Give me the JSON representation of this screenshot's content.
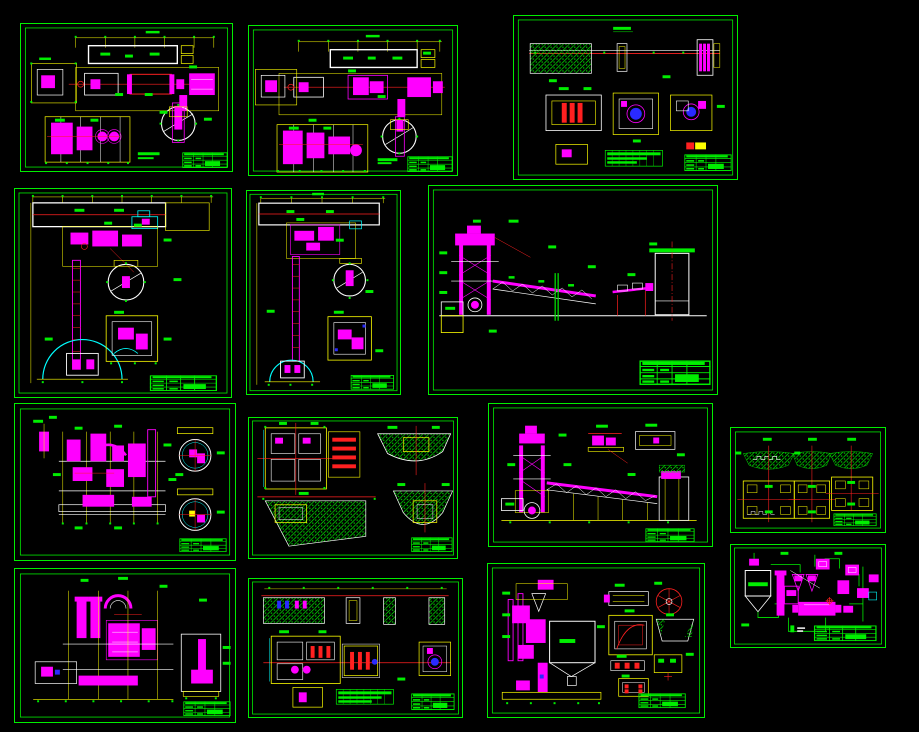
{
  "viewport": {
    "description": "CAD model-space viewport showing fourteen engineering drawing sheets",
    "sheet_count": 14,
    "text_legible": false
  },
  "palette": {
    "background": "#000000",
    "green": "#00ee00",
    "magenta": "#ff00ff",
    "yellow": "#ffff00",
    "red": "#ff2020",
    "white": "#ffffff",
    "cyan": "#00ffff",
    "blue": "#2a2aff"
  },
  "sheets": [
    {
      "id": "sheet-01",
      "kind": "equipment plan with mill circle"
    },
    {
      "id": "sheet-02",
      "kind": "equipment plan with mill circle"
    },
    {
      "id": "sheet-03",
      "kind": "foundation section and bearing plans"
    },
    {
      "id": "sheet-04",
      "kind": "bucket elevator elevation with dome base"
    },
    {
      "id": "sheet-05",
      "kind": "bucket elevator elevation with dome base"
    },
    {
      "id": "sheet-06",
      "kind": "plant elevation with truss conveyor and silo"
    },
    {
      "id": "sheet-07",
      "kind": "mill plant elevation with two section circles"
    },
    {
      "id": "sheet-08",
      "kind": "foundation plans and earth sections"
    },
    {
      "id": "sheet-09",
      "kind": "elevator and truss conveyor elevation"
    },
    {
      "id": "sheet-10",
      "kind": "three foundation trough details"
    },
    {
      "id": "sheet-11",
      "kind": "mill elevation with arched duct"
    },
    {
      "id": "sheet-12",
      "kind": "long foundation section and shaft plans"
    },
    {
      "id": "sheet-13",
      "kind": "plant elevation with detail views"
    },
    {
      "id": "sheet-14",
      "kind": "process flow diagram"
    }
  ],
  "title_block": {
    "present_on_every_sheet": true,
    "color": "#00ee00"
  }
}
